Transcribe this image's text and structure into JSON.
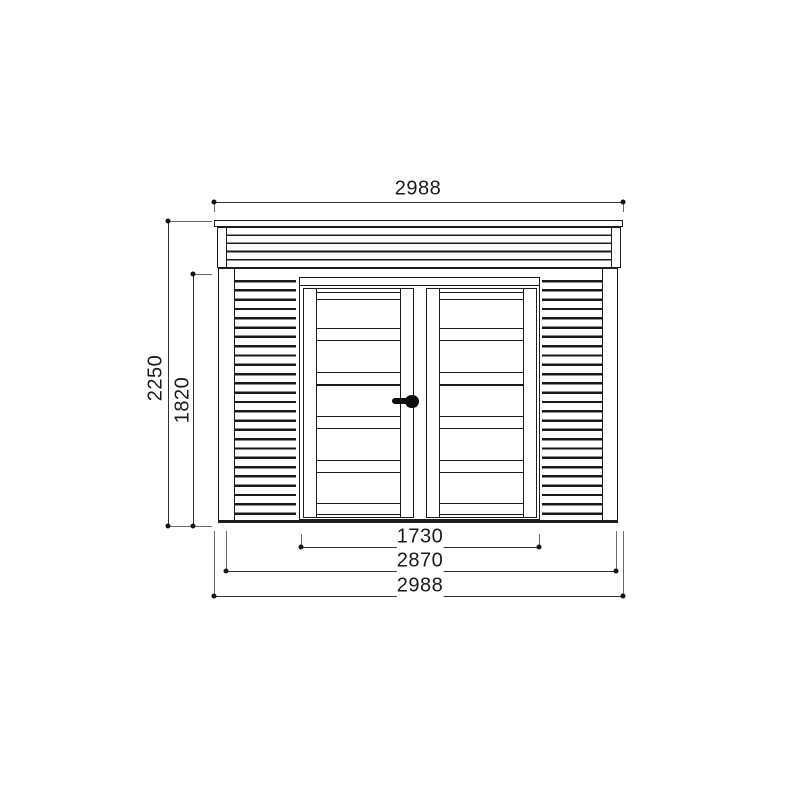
{
  "drawing": {
    "background_color": "#ffffff",
    "line_color": "#1c1c1c",
    "dimension_text_color": "#1a1a1a",
    "dimensions": {
      "roof_width": "2988",
      "overall_height": "2250",
      "wall_height": "1820",
      "door_frame_width": "1730",
      "wall_width": "2870",
      "overall_width": "2988"
    }
  }
}
